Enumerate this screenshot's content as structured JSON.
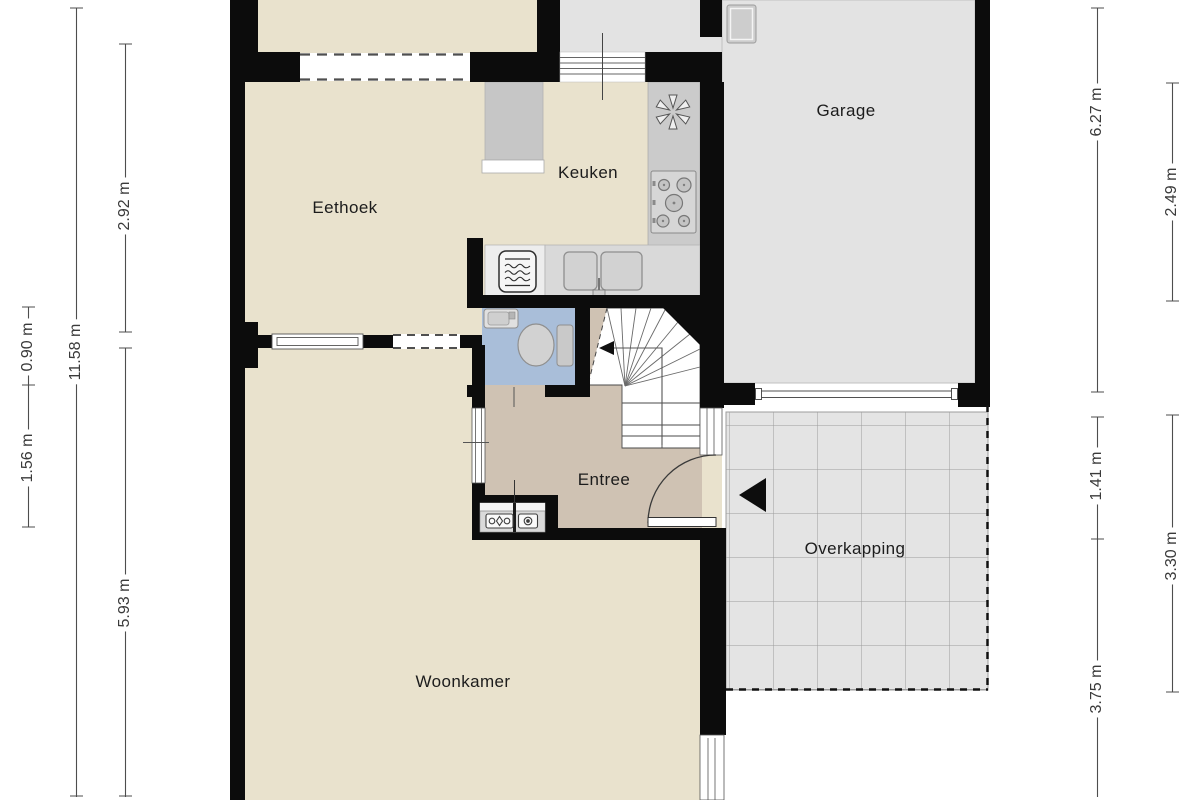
{
  "plan_type": "floor-plan",
  "rooms": [
    {
      "name": "eethoek",
      "label": "Eethoek"
    },
    {
      "name": "keuken",
      "label": "Keuken"
    },
    {
      "name": "garage",
      "label": "Garage"
    },
    {
      "name": "entree",
      "label": "Entree"
    },
    {
      "name": "woonkamer",
      "label": "Woonkamer"
    },
    {
      "name": "overkapping",
      "label": "Overkapping"
    }
  ],
  "dims": [
    {
      "side": "left",
      "label": "2.92 m"
    },
    {
      "side": "left",
      "label": "5.93 m"
    },
    {
      "side": "left",
      "label": "11.58 m"
    },
    {
      "side": "left",
      "label": "0.90 m"
    },
    {
      "side": "left",
      "label": "1.56 m"
    },
    {
      "side": "right",
      "label": "6.27 m"
    },
    {
      "side": "right",
      "label": "2.49 m"
    },
    {
      "side": "right",
      "label": "1.41 m"
    },
    {
      "side": "right",
      "label": "3.30 m"
    },
    {
      "side": "right",
      "label": "3.75 m"
    }
  ],
  "icons": [
    "extractor-fan-icon",
    "stove-icon",
    "double-sink-icon",
    "microwave-icon",
    "fridge-icon",
    "toilet-icon",
    "hand-basin-icon",
    "electricity-meter-icon",
    "gas-meter-icon",
    "stair-direction-arrow-icon",
    "entrance-arrow-icon",
    "boiler-icon"
  ],
  "colors": {
    "wall": "#0c0c0c",
    "floor_main": "#e9e2cd",
    "floor_entree": "#cfc2b3",
    "floor_toilet": "#a9bed9",
    "floor_garage": "#e4e4e4",
    "overkapping_tile": "#e4e4e4",
    "counter_gray": "#cbcbcb",
    "dimension_line": "#4d4d4d"
  }
}
